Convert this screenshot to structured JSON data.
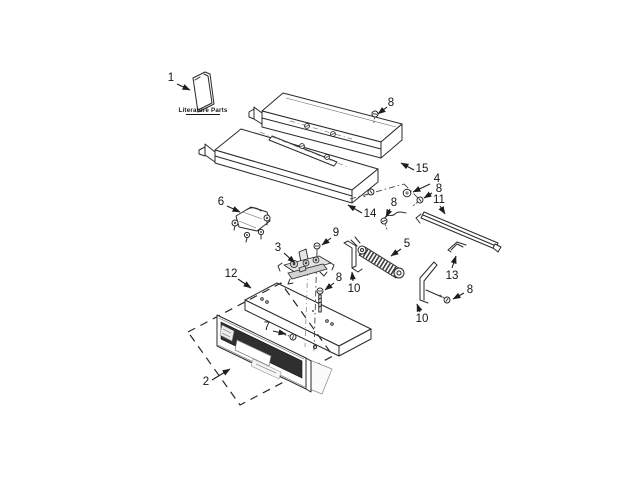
{
  "canvas": {
    "width": 640,
    "height": 480,
    "background": "#ffffff",
    "ink": "#2a2a2a"
  },
  "literature": {
    "label": "Literature Parts"
  },
  "callouts": [
    {
      "label": "1",
      "part": "literature-pack"
    },
    {
      "label": "8",
      "part": "screw-upper-panel"
    },
    {
      "label": "15",
      "part": "upper-rear-panel"
    },
    {
      "label": "4",
      "part": "spacer"
    },
    {
      "label": "8",
      "part": "screw-rear"
    },
    {
      "label": "11",
      "part": "support-rail"
    },
    {
      "label": "14",
      "part": "lower-rear-panel"
    },
    {
      "label": "8",
      "part": "ground-screw"
    },
    {
      "label": "6",
      "part": "latch-assembly"
    },
    {
      "label": "3",
      "part": "control-assembly"
    },
    {
      "label": "9",
      "part": "screw-control-top"
    },
    {
      "label": "12",
      "part": "shield-panel"
    },
    {
      "label": "8",
      "part": "screw-control-bottom"
    },
    {
      "label": "5",
      "part": "element"
    },
    {
      "label": "10",
      "part": "bracket-left"
    },
    {
      "label": "13",
      "part": "end-bracket"
    },
    {
      "label": "8",
      "part": "screw-bracket"
    },
    {
      "label": "10",
      "part": "bracket-right"
    },
    {
      "label": "7",
      "part": "panel-fastener"
    },
    {
      "label": "2",
      "part": "control-panel"
    }
  ]
}
